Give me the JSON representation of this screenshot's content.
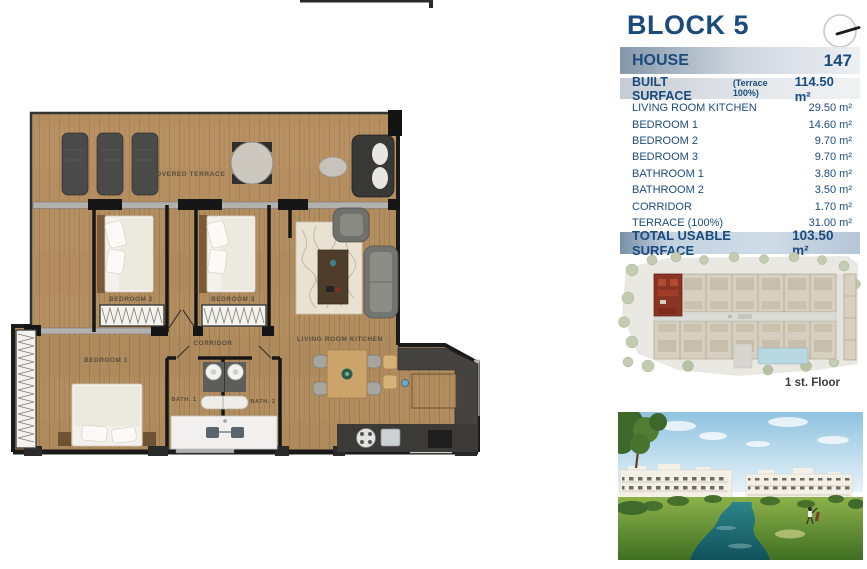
{
  "header": {
    "title": "BLOCK 5"
  },
  "house": {
    "label": "HOUSE",
    "number": "147"
  },
  "built_surface": {
    "label": "BUILT SURFACE",
    "note": "(Terrace 100%)",
    "value": "114.50 m²"
  },
  "surface_rows": [
    {
      "label": "LIVING ROOM KITCHEN",
      "value": "29.50 m²"
    },
    {
      "label": "BEDROOM 1",
      "value": "14.60 m²"
    },
    {
      "label": "BEDROOM 2",
      "value": "9.70 m²"
    },
    {
      "label": "BEDROOM 3",
      "value": "9.70 m²"
    },
    {
      "label": "BATHROOM 1",
      "value": "3.80 m²"
    },
    {
      "label": "BATHROOM 2",
      "value": "3.50 m²"
    },
    {
      "label": "CORRIDOR",
      "value": "1.70 m²"
    },
    {
      "label": "TERRACE (100%)",
      "value": "31.00 m²"
    }
  ],
  "total": {
    "label": "TOTAL USABLE SURFACE",
    "value": "103.50 m²"
  },
  "site_plan": {
    "floor_label": "1 st. Floor"
  },
  "floor_plan": {
    "covered_terrace": "COVERED TERRACE",
    "bedroom_1": "BEDROOM 1",
    "bedroom_2": "BEDROOM 2",
    "bedroom_3": "BEDROOM 3",
    "corridor": "CORRIDOR",
    "bath_1": "BATH. 1",
    "bath_2": "BATH. 2",
    "living_room_kitchen": "LIVING ROOM KITCHEN"
  },
  "colors": {
    "accent_navy": "#1b4a7c",
    "bar_slate": "#8597ab",
    "total_blue": "#c3d2e0",
    "wood": "#b28d60",
    "highlight_red": "#8a3424",
    "water_teal": "#2e8489"
  }
}
